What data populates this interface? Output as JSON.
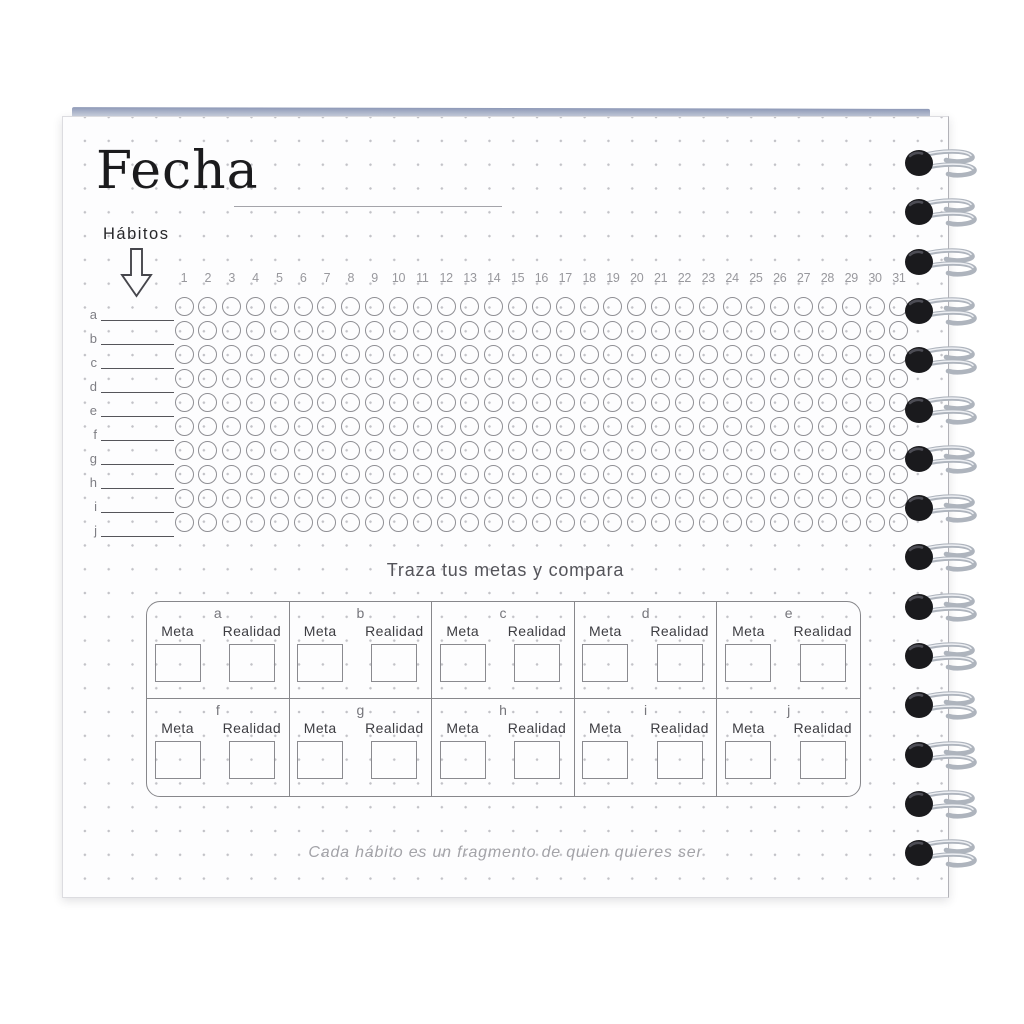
{
  "page_title": "Fecha",
  "habits": {
    "label": "Hábitos",
    "rows": [
      "a",
      "b",
      "c",
      "d",
      "e",
      "f",
      "g",
      "h",
      "i",
      "j"
    ]
  },
  "calendar": {
    "day_numbers": [
      1,
      2,
      3,
      4,
      5,
      6,
      7,
      8,
      9,
      10,
      11,
      12,
      13,
      14,
      15,
      16,
      17,
      18,
      19,
      20,
      21,
      22,
      23,
      24,
      25,
      26,
      27,
      28,
      29,
      30,
      31
    ]
  },
  "goals_section": {
    "title": "Traza tus metas y compara",
    "cell_letters": [
      "a",
      "b",
      "c",
      "d",
      "e",
      "f",
      "g",
      "h",
      "i",
      "j"
    ],
    "meta_label": "Meta",
    "realidad_label": "Realidad"
  },
  "quote": "Cada hábito es un fragmento de quien quieres ser",
  "binding": {
    "ring_count": 15
  },
  "colors": {
    "page_bg": "#fdfdfe",
    "dot_grid": "#c2c2c7",
    "circle_stroke": "#8f8f94",
    "ink_dark": "#1b1b1d",
    "ink_gray": "#54545a",
    "ink_light": "#a3a3a8",
    "table_line": "#87878b",
    "binding_black": "#1a1a1d",
    "wire_silver": "#aeb4bd",
    "stack_edge_blue": "#8d98b6"
  }
}
